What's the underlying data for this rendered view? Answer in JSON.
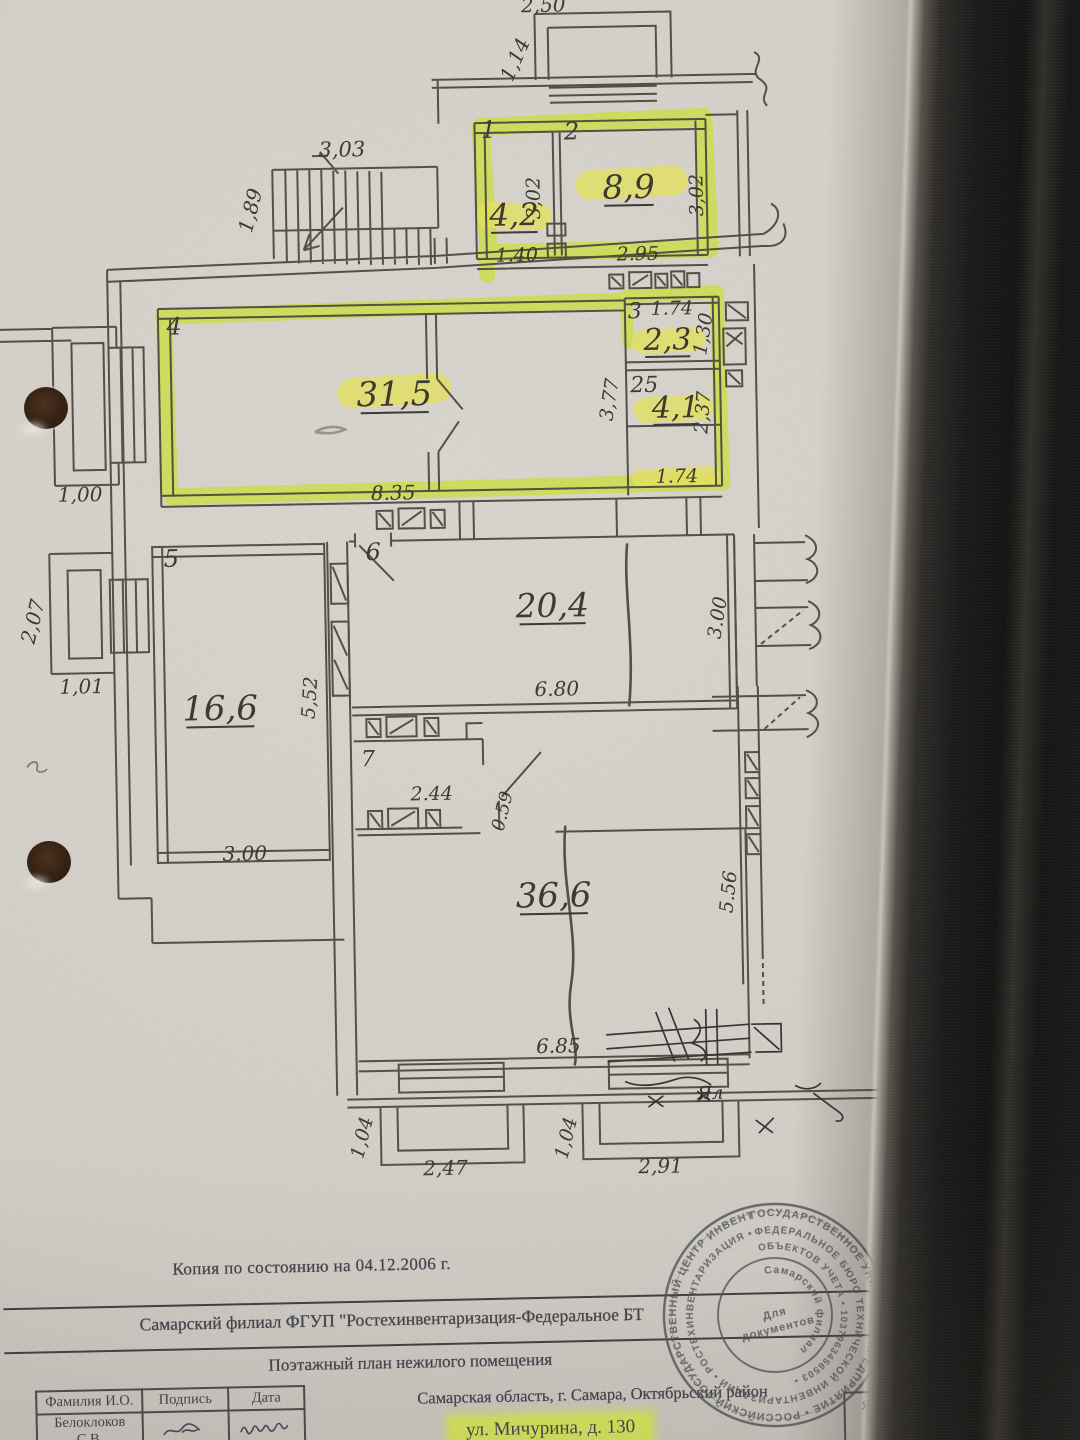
{
  "colors": {
    "highlighter": "#d3e54a",
    "highlighter_soft": "#e7e55f",
    "paper": "#d7d3cd",
    "ink": "#45423b",
    "scan_text": "#3e4049",
    "stamp_ink": "#4d5056"
  },
  "plan": {
    "rooms": [
      {
        "number": "1",
        "area": "4,2",
        "highlighted": true
      },
      {
        "number": "2",
        "area": "8,9",
        "highlighted": true
      },
      {
        "number": "3",
        "area": "2,3",
        "highlighted": true
      },
      {
        "number": "25",
        "area": "4,1",
        "highlighted": true
      },
      {
        "number": "4",
        "area": "31,5",
        "highlighted": true
      },
      {
        "number": "5",
        "area": "16,6",
        "highlighted": false
      },
      {
        "number": "6",
        "area": "20,4",
        "highlighted": false
      },
      {
        "number": "7",
        "area": "",
        "highlighted": false
      },
      {
        "number": "",
        "area": "36,6",
        "highlighted": false
      }
    ],
    "labels": [
      {
        "t": "2,50",
        "x": 556,
        "y": 12,
        "s": 20,
        "c": "dim"
      },
      {
        "t": "1,14",
        "x": 533,
        "y": 62,
        "s": 20,
        "r": -65,
        "c": "dim"
      },
      {
        "t": "3,03",
        "x": 352,
        "y": 153,
        "s": 21,
        "c": "dim"
      },
      {
        "t": "1,89",
        "x": 266,
        "y": 207,
        "s": 20,
        "r": -75,
        "c": "dim"
      },
      {
        "t": "1",
        "x": 499,
        "y": 137,
        "s": 24,
        "c": "room"
      },
      {
        "t": "2",
        "x": 582,
        "y": 140,
        "s": 24,
        "c": "room"
      },
      {
        "t": "4,2",
        "x": 523,
        "y": 225,
        "s": 31,
        "u": 1,
        "c": "area"
      },
      {
        "t": "8,9",
        "x": 638,
        "y": 200,
        "s": 33,
        "u": 1,
        "c": "area"
      },
      {
        "t": "3,02",
        "x": 549,
        "y": 198,
        "s": 19,
        "r": -90,
        "c": "dim"
      },
      {
        "t": "3,02",
        "x": 712,
        "y": 198,
        "s": 19,
        "r": -90,
        "c": "dim"
      },
      {
        "t": "1.40",
        "x": 525,
        "y": 261,
        "s": 19,
        "c": "dim"
      },
      {
        "t": "2.95",
        "x": 646,
        "y": 262,
        "s": 19,
        "c": "dim"
      },
      {
        "t": "3",
        "x": 642,
        "y": 320,
        "s": 22,
        "c": "room"
      },
      {
        "t": "1.74",
        "x": 679,
        "y": 317,
        "s": 19,
        "c": "dim"
      },
      {
        "t": "2,3",
        "x": 674,
        "y": 352,
        "s": 30,
        "u": 1,
        "c": "area"
      },
      {
        "t": "1,30",
        "x": 716,
        "y": 338,
        "s": 19,
        "r": -80,
        "c": "dim"
      },
      {
        "t": "25",
        "x": 650,
        "y": 394,
        "s": 22,
        "c": "room"
      },
      {
        "t": "4,1",
        "x": 681,
        "y": 420,
        "s": 30,
        "u": 1,
        "c": "area"
      },
      {
        "t": "2,37",
        "x": 714,
        "y": 416,
        "s": 19,
        "r": -85,
        "c": "dim"
      },
      {
        "t": "3,77",
        "x": 621,
        "y": 402,
        "s": 19,
        "r": -80,
        "c": "dim"
      },
      {
        "t": "1.74",
        "x": 681,
        "y": 485,
        "s": 19,
        "c": "dim"
      },
      {
        "t": "4",
        "x": 181,
        "y": 328,
        "s": 24,
        "c": "room"
      },
      {
        "t": "31,5",
        "x": 400,
        "y": 403,
        "s": 34,
        "u": 1,
        "c": "area"
      },
      {
        "t": "8.35",
        "x": 397,
        "y": 497,
        "s": 20,
        "c": "dim"
      },
      {
        "t": "1,00",
        "x": 84,
        "y": 493,
        "s": 20,
        "c": "dim"
      },
      {
        "t": "0",
        "x": 51,
        "y": 390,
        "s": 18,
        "r": -80,
        "c": "dim"
      },
      {
        "t": "2,07",
        "x": 41,
        "y": 614,
        "s": 20,
        "r": -75,
        "c": "dim"
      },
      {
        "t": "1,01",
        "x": 82,
        "y": 685,
        "s": 20,
        "c": "dim"
      },
      {
        "t": "5",
        "x": 174,
        "y": 560,
        "s": 24,
        "c": "room"
      },
      {
        "t": "16,6",
        "x": 220,
        "y": 714,
        "s": 34,
        "u": 1,
        "c": "area"
      },
      {
        "t": "5,52",
        "x": 316,
        "y": 694,
        "s": 19,
        "r": -85,
        "c": "dim"
      },
      {
        "t": "3.00",
        "x": 242,
        "y": 855,
        "s": 20,
        "c": "dim"
      },
      {
        "t": "6",
        "x": 376,
        "y": 557,
        "s": 24,
        "c": "room"
      },
      {
        "t": "20,4",
        "x": 554,
        "y": 617,
        "s": 33,
        "u": 1,
        "c": "area"
      },
      {
        "t": "6.80",
        "x": 557,
        "y": 696,
        "s": 20,
        "c": "dim"
      },
      {
        "t": "3.00",
        "x": 725,
        "y": 622,
        "s": 19,
        "r": -80,
        "c": "dim"
      },
      {
        "t": "7",
        "x": 367,
        "y": 763,
        "s": 22,
        "c": "room"
      },
      {
        "t": "2.44",
        "x": 430,
        "y": 798,
        "s": 19,
        "c": "dim"
      },
      {
        "t": "0.59",
        "x": 506,
        "y": 812,
        "s": 18,
        "r": -75,
        "c": "dim"
      },
      {
        "t": "36,6",
        "x": 550,
        "y": 907,
        "s": 34,
        "u": 1,
        "c": "area"
      },
      {
        "t": "6.85",
        "x": 552,
        "y": 1053,
        "s": 20,
        "c": "dim"
      },
      {
        "t": "5.56",
        "x": 731,
        "y": 896,
        "s": 19,
        "r": -83,
        "c": "dim"
      },
      {
        "t": "1,04",
        "x": 360,
        "y": 1136,
        "s": 19,
        "r": -75,
        "c": "dim"
      },
      {
        "t": "2,47",
        "x": 437,
        "y": 1173,
        "s": 20,
        "c": "dim"
      },
      {
        "t": "1,04",
        "x": 564,
        "y": 1140,
        "s": 19,
        "r": -75,
        "c": "dim"
      },
      {
        "t": "2,91",
        "x": 652,
        "y": 1175,
        "s": 20,
        "c": "dim"
      },
      {
        "t": "Ял",
        "x": 703,
        "y": 1102,
        "s": 18,
        "c": "hand"
      }
    ]
  },
  "footer": {
    "copy_line": "Копия по состоянию на 04.12.2006 г.",
    "org_line": "Самарский филиал ФГУП \"Ростехинвентаризация-Федеральное БТ",
    "plan_title": "Поэтажный план нежилого помещения",
    "table": {
      "headers": [
        "Фамилия И.О.",
        "Подпись",
        "Дата"
      ],
      "rows": [
        {
          "name": "Белоклоков С.В."
        }
      ]
    },
    "address_line": "Самарская область, г. Самара, Октябрьский район",
    "address_highlight": "ул. Мичурина, д. 130",
    "side_note": "Яис"
  },
  "stamp": {
    "ring_outer": "ГОСУДАРСТВЕННОЕ УНИТАРНОЕ ПРЕДПРИЯТИЕ • РОССИЙСКИЙ ГОСУДАРСТВЕННЫЙ ЦЕНТР ИНВЕНТАРИЗАЦИИ •",
    "ring_middle": "ФЕДЕРАЛЬНОЕ БЮРО ТЕХНИЧЕСКОЙ ИНВЕНТАРИЗАЦИИ • РОСТЕХИНВЕНТАРИЗАЦИЯ •",
    "ring_inner": "ОБЪЕКТОВ УЧЕТА • 1037963456503 •",
    "center_arc": "Самарский филиал",
    "center_word": "Для",
    "center_word2": "документов"
  }
}
